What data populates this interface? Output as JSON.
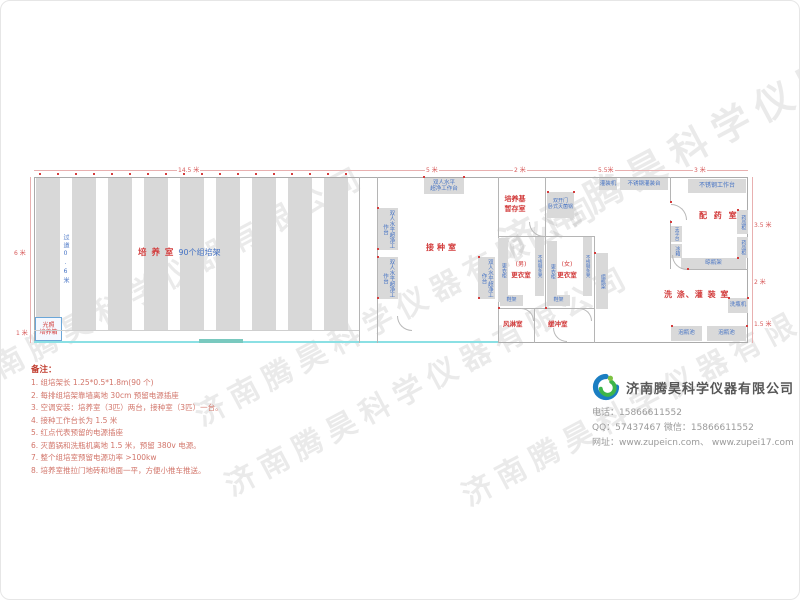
{
  "watermark_text": "济南腾昊科学仪器有限公司",
  "dimensions": {
    "top": {
      "culture": "14.5 米",
      "inoculation": "5 米",
      "storage": "2 米",
      "washing": "5.5米",
      "pharmacy": "3 米"
    },
    "left": {
      "room": "6 米",
      "corridor": "1 米"
    },
    "right": {
      "upper": "3.5 米",
      "middle": "2 米",
      "lower": "1.5 米"
    }
  },
  "rooms": {
    "culture": {
      "name": "培 养 室",
      "racks": "90个组培架",
      "aisle": "过道0.6米",
      "incubator_line1": "光照",
      "incubator_line2": "培养箱"
    },
    "inoculation": {
      "name": "接种室",
      "bench_line1": "双人水平",
      "bench_line2": "超净工作台",
      "bench_full": "双人水平超净工作台"
    },
    "medium_storage": {
      "name_line1": "培养基",
      "name_line2": "暂存室"
    },
    "sterilizing": {
      "autoclave_line1": "双开门",
      "autoclave_line2": "卧式灭菌锅",
      "filling_machine": "灌装机",
      "filling_table": "不锈钢灌装台"
    },
    "changing": {
      "male_line1": "(男)",
      "male_line2": "更衣室",
      "female_line1": "(女)",
      "female_line2": "更衣室",
      "locker": "更衣柜",
      "bench": "不锈钢条凳",
      "shoe_rack": "鞋架",
      "air_shower": "风淋室",
      "buffer": "缓冲室"
    },
    "washing": {
      "name": "洗 涤、灌 装 室",
      "bottle_washer": "洗瓶机",
      "soak_pool": "泡瓶池",
      "bottle_rack": "组瓶架"
    },
    "pharmacy": {
      "name": "配 药 室",
      "worktable": "不锈钢工作台",
      "cabinet": "药品柜",
      "balance": "天平台",
      "fridge": "冰箱",
      "drying_rack": "晾瓶架"
    }
  },
  "notes": {
    "title": "备注：",
    "items": [
      "1.  组培架长 1.25*0.5*1.8m(90 个)",
      "2.  每排组培架靠墙离地 30cm 预留电源插座",
      "3.  空调安装：培养室（3匹）两台，接种室（3匹）一台。",
      "4.  接种工作台长为 1.5 米",
      "5.  红点代表预留的电源插座",
      "6.  灭菌锅和洗瓶机离地 1.5 米，预留 380v 电源。",
      "7.  整个组培室预留电源功率 >100kw",
      "8.  培养室推拉门地砖和地面一平，方便小推车推送。"
    ]
  },
  "company": {
    "name": "济南腾昊科学仪器有限公司",
    "phone": "电话：15866611552",
    "qq_wechat": "QQ：57437467    微信：15866611552",
    "website": "网址：www.zupeicn.com、  www.zupei17.com"
  }
}
